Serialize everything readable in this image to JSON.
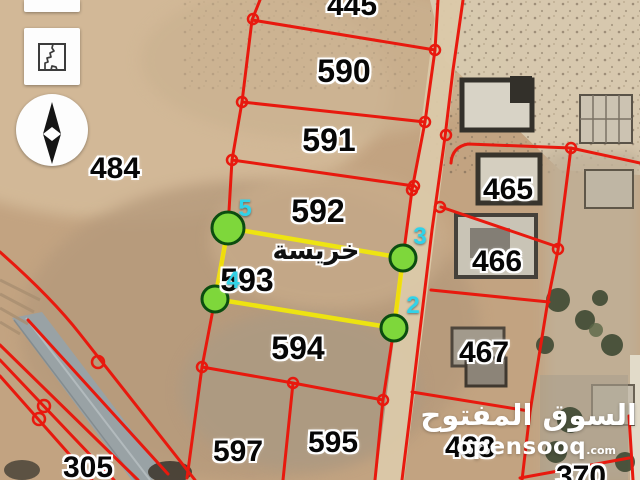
{
  "map": {
    "area_label": "خريسة",
    "parcels": [
      {
        "label": "445"
      },
      {
        "label": "590"
      },
      {
        "label": "591"
      },
      {
        "label": "592"
      },
      {
        "label": "593"
      },
      {
        "label": "594"
      },
      {
        "label": "595"
      },
      {
        "label": "597"
      },
      {
        "label": "305"
      },
      {
        "label": "484"
      },
      {
        "label": "465"
      },
      {
        "label": "466"
      },
      {
        "label": "467"
      },
      {
        "label": "468"
      },
      {
        "label": "370"
      }
    ],
    "vertex_labels": [
      {
        "label": "5"
      },
      {
        "label": "3"
      },
      {
        "label": "4"
      },
      {
        "label": "2"
      }
    ]
  },
  "watermark": {
    "brand_arabic": "السوق المفتوح",
    "brand_latin": "opensooq",
    "domain_suffix": ".com"
  },
  "controls": {
    "map_type_icon": "map-outline-icon",
    "compass_icon": "north-arrow-icon"
  },
  "colors": {
    "parcel_line": "#e8190e",
    "highlight_line": "#f0e70c",
    "corner_marker_fill": "#7ed73b",
    "corner_marker_stroke": "#0b4d10",
    "vertex_label": "#31d2e8"
  }
}
